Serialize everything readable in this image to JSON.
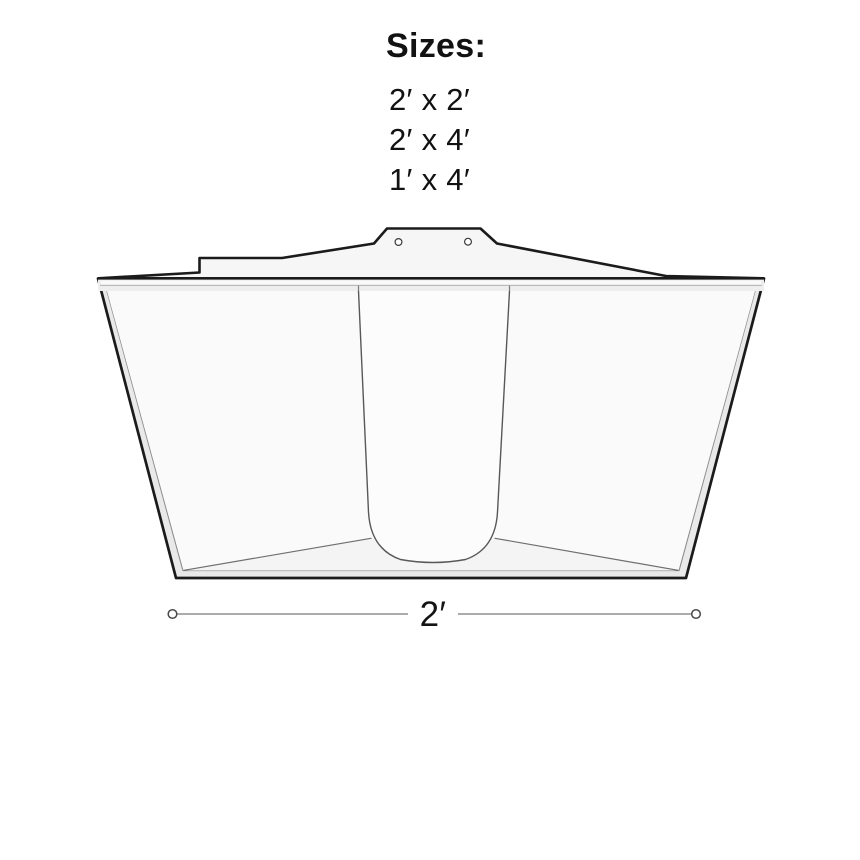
{
  "sizes_panel": {
    "title": "Sizes:",
    "options": [
      "2′ x 2′",
      "2′ x 4′",
      "1′ x 4′"
    ]
  },
  "diagram": {
    "dimension_label": "2′",
    "colors": {
      "outline": "#1b1b1b",
      "detail_line": "#8c8c8c",
      "housing_fill": "#f5f6f5",
      "rim_fill": "#e9e9e9",
      "wall_fill": "#fafafa",
      "floor_fill": "#f4f4f4",
      "lens_fill": "#fcfcfc",
      "flange_fill": "#eeeeee",
      "dimension_line": "#7a7a7a",
      "text": "#121212",
      "background": "#ffffff"
    }
  }
}
